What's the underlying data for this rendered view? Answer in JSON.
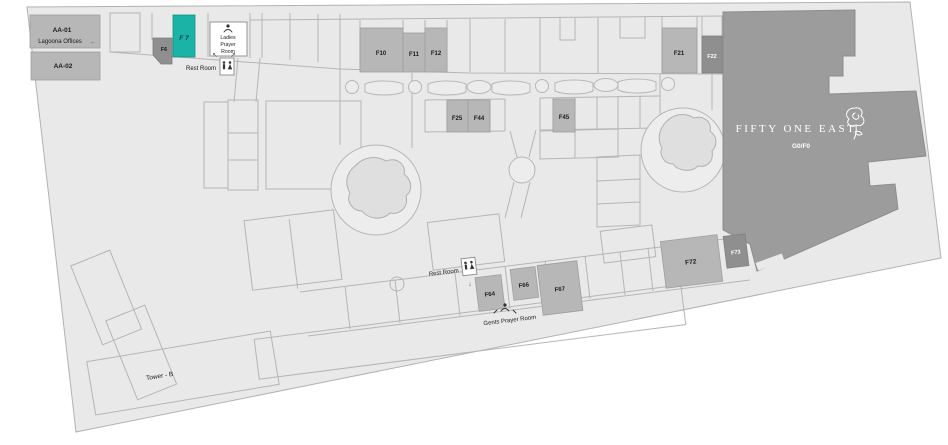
{
  "units": {
    "aa01": {
      "label": "AA-01",
      "sublabel": "Lagoona Offices"
    },
    "aa02": {
      "label": "AA-02"
    },
    "f6": {
      "label": "F6"
    },
    "f7": {
      "label": "F 7"
    },
    "f10": {
      "label": "F10"
    },
    "f11": {
      "label": "F11"
    },
    "f12": {
      "label": "F12"
    },
    "f21": {
      "label": "F21"
    },
    "f22": {
      "label": "F22"
    },
    "f25": {
      "label": "F25"
    },
    "f44": {
      "label": "F44"
    },
    "f45": {
      "label": "F45"
    },
    "f64": {
      "label": "F64"
    },
    "f66": {
      "label": "F66"
    },
    "f67": {
      "label": "F67"
    },
    "f72": {
      "label": "F72"
    },
    "f73": {
      "label": "F73"
    }
  },
  "anchors": {
    "fifty_one_east": {
      "name": "FIFTY ONE EAST",
      "floor": "G0/F0"
    },
    "tower_b": {
      "label": "Tower - B"
    }
  },
  "facilities": {
    "ladies_prayer_room": {
      "lines": [
        "Ladies",
        "Prayer",
        "Room"
      ]
    },
    "rest_room_top": {
      "label": "Rest Room"
    },
    "rest_room_bottom": {
      "label": "Rest Room"
    },
    "gents_prayer_room": {
      "label": "Gents Prayer Room"
    }
  },
  "icons": {
    "left_arrow": "←",
    "up_left_arrow": "↖",
    "up_right_arrow": "↗",
    "down_arrow": "↓"
  },
  "colors": {
    "highlight": "#1ab3a5",
    "unit_fill": "#b7b7b7",
    "dark_unit_fill": "#8f8f8f",
    "anchor_fill": "#9c9c9c",
    "map_fill": "#e9e9e9",
    "outline": "#b5b5b5"
  }
}
